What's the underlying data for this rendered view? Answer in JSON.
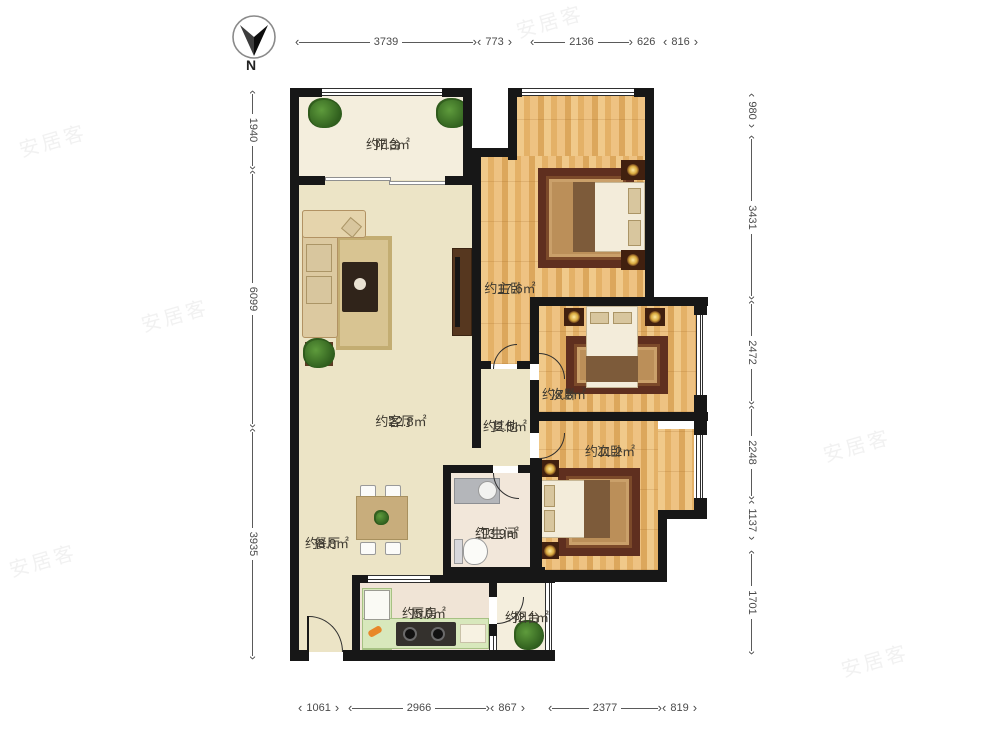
{
  "compass": {
    "label": "N"
  },
  "watermark": {
    "text": "安居客"
  },
  "rooms": [
    {
      "key": "balcony_top",
      "name": "阳台",
      "area": "约7.3㎡"
    },
    {
      "key": "master_bedroom",
      "name": "主卧",
      "area": "约17.6㎡"
    },
    {
      "key": "living_room",
      "name": "客厅",
      "area": "约22.8㎡"
    },
    {
      "key": "other",
      "name": "其他",
      "area": "约2.5㎡"
    },
    {
      "key": "bedroom_2",
      "name": "次卧",
      "area": "约8.8㎡"
    },
    {
      "key": "bedroom_3",
      "name": "次卧",
      "area": "约11.2㎡"
    },
    {
      "key": "dining_room",
      "name": "餐厅",
      "area": "约8.8㎡"
    },
    {
      "key": "bathroom",
      "name": "卫生间",
      "area": "约3.9㎡"
    },
    {
      "key": "kitchen",
      "name": "厨房",
      "area": "约5.0㎡"
    },
    {
      "key": "balcony_bottom",
      "name": "阳台",
      "area": "约2.1㎡"
    }
  ],
  "dimensions": {
    "top": [
      "3739",
      "773",
      "2136",
      "626",
      "816"
    ],
    "bottom": [
      "1061",
      "2966",
      "867",
      "2377",
      "819"
    ],
    "left": [
      "1940",
      "6099",
      "3935"
    ],
    "right": [
      "980",
      "3431",
      "2472",
      "2248",
      "1137",
      "1701"
    ]
  },
  "colors": {
    "wall": "#171717",
    "wood_floor": "#e9bd78",
    "cream_floor": "#ece4c6",
    "balcony_floor": "#f4eedd",
    "bath_floor": "#f2e7da",
    "kitchen_floor": "#f0e4d6",
    "counter_green": "#d8e8bc",
    "rug": "#5f2f1f",
    "plant": "#3f7a2e"
  }
}
